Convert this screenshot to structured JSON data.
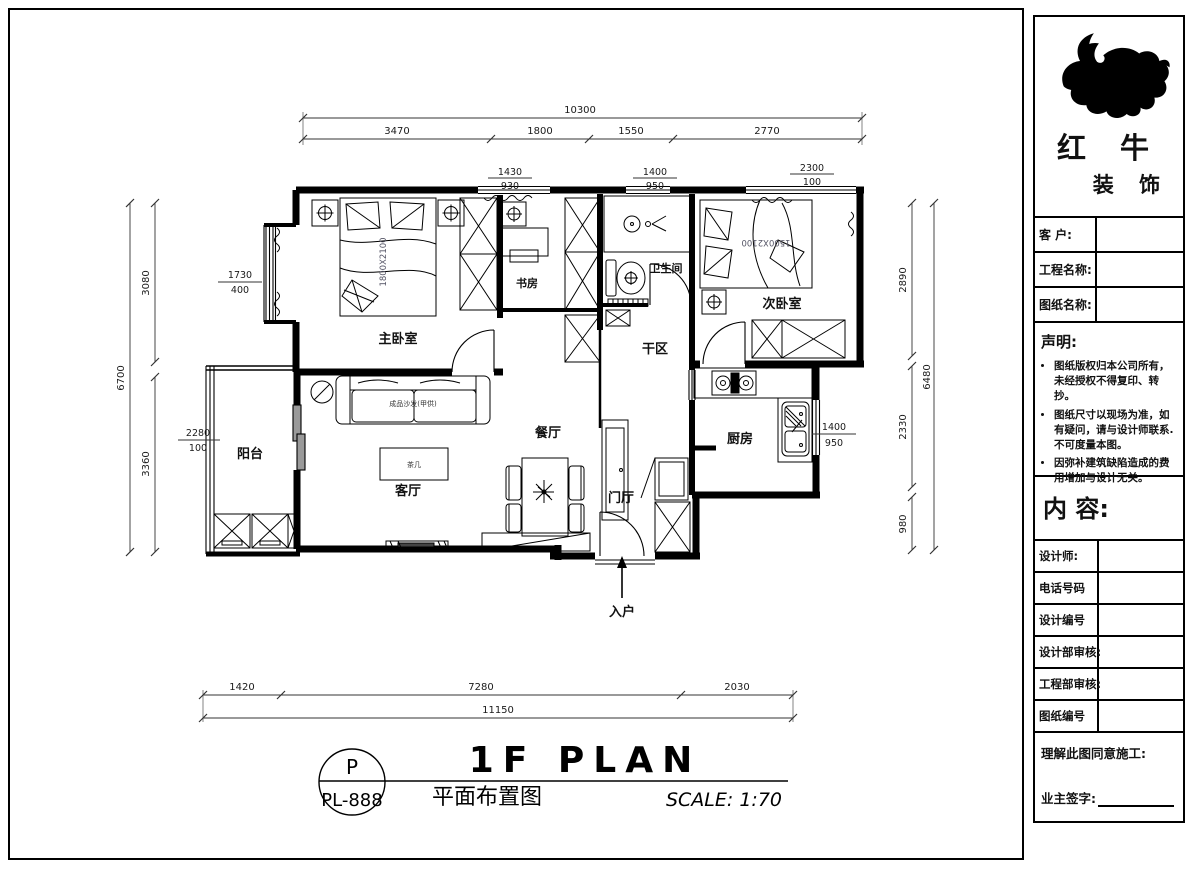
{
  "sheet": {
    "plan": {
      "rooms": {
        "master_bedroom": "主卧室",
        "study": "书房",
        "bathroom": "卫生间",
        "second_bedroom": "次卧室",
        "dry_area": "干区",
        "dining": "餐厅",
        "kitchen": "厨房",
        "living": "客厅",
        "foyer": "门厅",
        "balcony": "阳台",
        "entry": "入户"
      },
      "furniture": {
        "sofa": "成品沙发(甲供)",
        "tea_table": "茶几",
        "master_bed_size": "1800X2100",
        "second_bed_size": "1500X2100"
      },
      "dims": {
        "top_total": "10300",
        "top_s1": "3470",
        "top_s2": "1800",
        "top_s3": "1550",
        "top_s4": "2770",
        "w_study_a": "1430",
        "w_study_b": "930",
        "w_bath_a": "1400",
        "w_bath_b": "950",
        "w_bed2_a": "2300",
        "w_bed2_b": "100",
        "left_total": "6700",
        "left_s1": "3080",
        "left_s2": "3360",
        "w_bay_a": "1730",
        "w_bay_b": "400",
        "w_balc_a": "2280",
        "w_balc_b": "100",
        "right_total": "6480",
        "right_s1": "2890",
        "right_s2": "2330",
        "right_s3": "980",
        "w_kit_a": "1400",
        "w_kit_b": "950",
        "bottom_total": "11150",
        "bottom_s1": "1420",
        "bottom_s2": "7280",
        "bottom_s3": "2030"
      }
    },
    "title": {
      "circle_top": "P",
      "circle_code": "PL-888",
      "heading_en": "1F PLAN",
      "heading_cn": "平面布置图",
      "scale": "SCALE: 1:70"
    },
    "sidebar": {
      "brand": {
        "name_top": "红 牛",
        "name_bottom": "装 饰"
      },
      "fields": {
        "customer": "客 户:",
        "project_name": "工程名称:",
        "drawing_name": "图纸名称:"
      },
      "statement": {
        "title": "声明:",
        "items": [
          "图纸版权归本公司所有，未经授权不得复印、转抄。",
          "图纸尺寸以现场为准，如有疑问，请与设计师联系. 不可度量本图。",
          "因弥补建筑缺陷造成的费用增加与设计无关。"
        ]
      },
      "content_label": "内 容:",
      "info_fields": [
        "设计师:",
        "电话号码",
        "设计编号",
        "设计部审核:",
        "工程部审核:",
        "图纸编号"
      ],
      "footer": {
        "line1": "理解此图同意施工:",
        "line2": "业主签字:"
      }
    }
  }
}
